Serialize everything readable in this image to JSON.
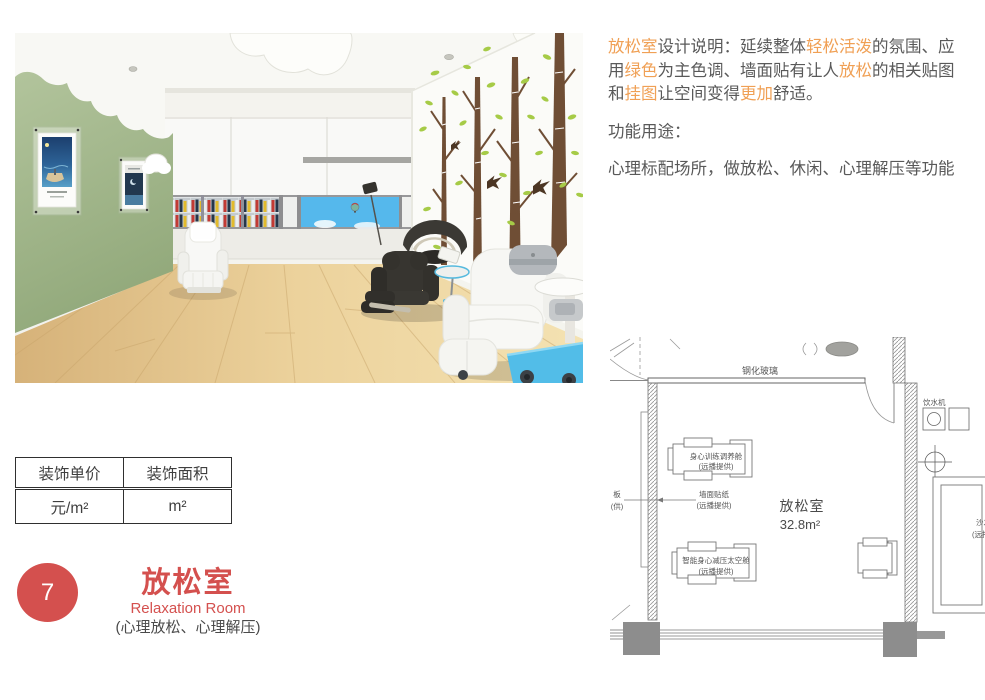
{
  "description": {
    "segments": [
      {
        "text": "放松室",
        "hl": true
      },
      {
        "text": "设计说明：延续整体",
        "hl": false
      },
      {
        "text": "轻松活泼",
        "hl": true
      },
      {
        "text": "的氛围、应用",
        "hl": false
      },
      {
        "text": "绿色",
        "hl": true
      },
      {
        "text": "为主色调、墙面贴有让人",
        "hl": false
      },
      {
        "text": "放松",
        "hl": true
      },
      {
        "text": "的相关贴图和",
        "hl": false
      },
      {
        "text": "挂图",
        "hl": true
      },
      {
        "text": "让空间变得",
        "hl": false
      },
      {
        "text": "更加",
        "hl": true
      },
      {
        "text": "舒适。",
        "hl": false
      }
    ],
    "function_label": "功能用途：",
    "function_text": "心理标配场所，做放松、休闲、心理解压等功能",
    "text_color": "#595959",
    "highlight_color": "#f0a055"
  },
  "spec_table": {
    "headers": [
      "装饰单价",
      "装饰面积"
    ],
    "values": [
      "元/m²",
      "m²"
    ]
  },
  "title_block": {
    "number": "7",
    "title_cn": "放松室",
    "title_en": "Relaxation Room",
    "subtitle": "(心理放松、心理解压)",
    "accent_color": "#d4504e"
  },
  "floorplan": {
    "tempered_glass": "钢化玻璃",
    "room_name": "放松室",
    "room_area": "32.8m²",
    "cabin1_line1": "身心训练调养舱",
    "cabin1_line2": "(远播提供)",
    "wall_sticker_line1": "墙面贴纸",
    "wall_sticker_line2": "(远播提供)",
    "cabin2_line1": "智能身心减压太空舱",
    "cabin2_line2": "(远播提供)",
    "water_label": "饮水机",
    "left_partial_line1": "板",
    "left_partial_line2": "(供)",
    "sofa_line1": "沙发",
    "sofa_line2": "(远播提供)"
  },
  "render_colors": {
    "wall_green": "#a9bd92",
    "floor_wood": "#e9d09a",
    "sky_blue": "#55b8ec",
    "leaf_green": "#a6cb47",
    "trunk_brown": "#6f4e35",
    "accent_blue": "#52bde8"
  }
}
